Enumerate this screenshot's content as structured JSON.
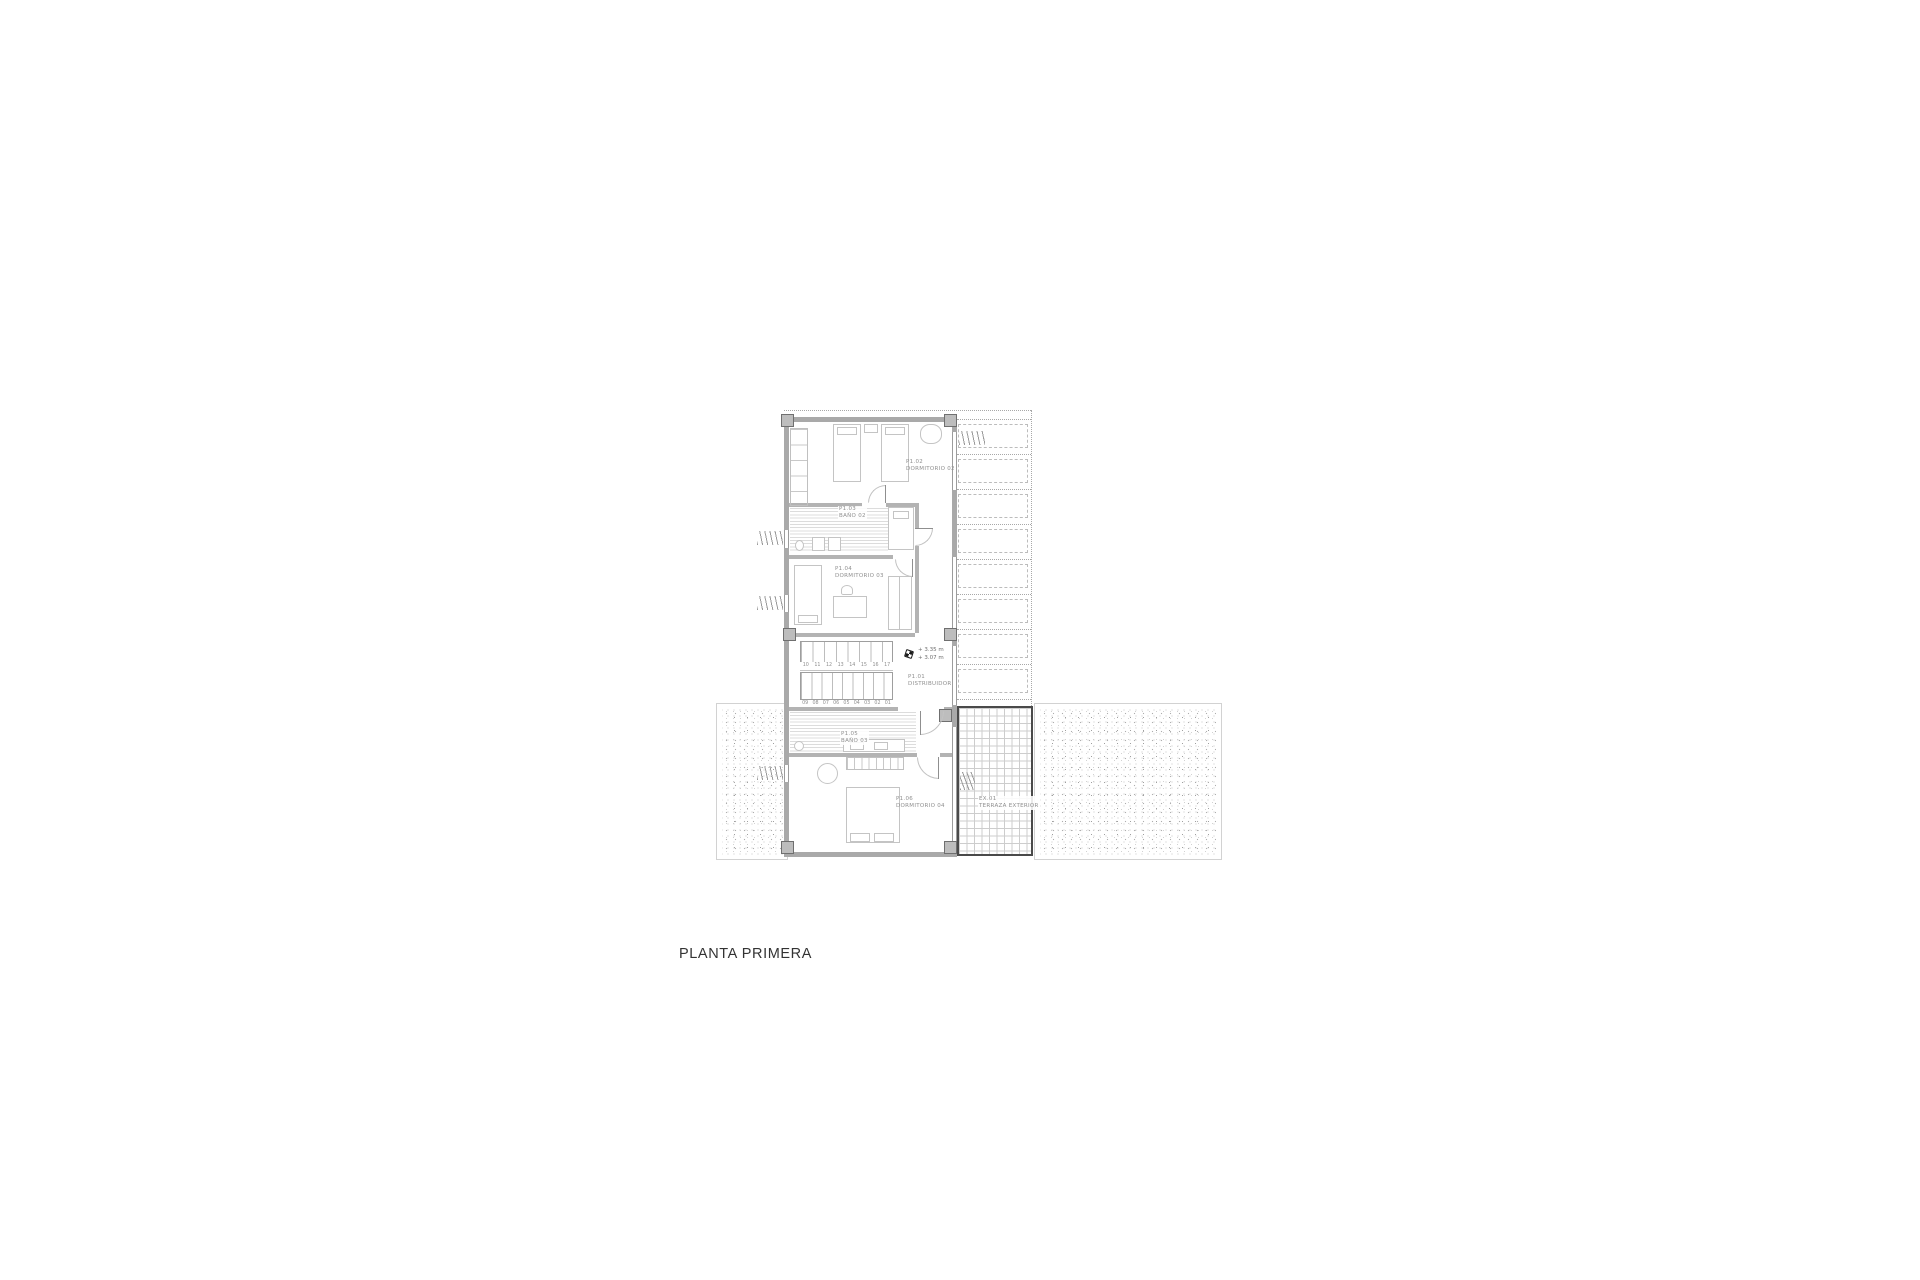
{
  "title": "PLANTA PRIMERA",
  "drawing": {
    "rooms": [
      {
        "code": "P1.02",
        "name": "DORMITORIO 02"
      },
      {
        "code": "P1.03",
        "name": "BAÑO 02"
      },
      {
        "code": "P1.04",
        "name": "DORMITORIO 03"
      },
      {
        "code": "P1.01",
        "name": "DISTRIBUIDOR"
      },
      {
        "code": "P1.05",
        "name": "BAÑO 03"
      },
      {
        "code": "P1.06",
        "name": "DORMITORIO 04"
      },
      {
        "code": "EX.01",
        "name": "TERRAZA EXTERIOR"
      }
    ],
    "levels": {
      "upper": "+ 3.35 m",
      "lower": "+ 3.07 m"
    },
    "stairs": {
      "up_flight": [
        "10",
        "11",
        "12",
        "13",
        "14",
        "15",
        "16",
        "17"
      ],
      "down_flight": [
        "09",
        "08",
        "07",
        "06",
        "05",
        "04",
        "03",
        "02",
        "01"
      ]
    },
    "colors": {
      "wall": "#a9a9a9",
      "furniture_line": "#c4c4c4",
      "label_text": "#8f8f8f",
      "title_text": "#333333",
      "terrace_border": "#4a4a4a"
    }
  }
}
